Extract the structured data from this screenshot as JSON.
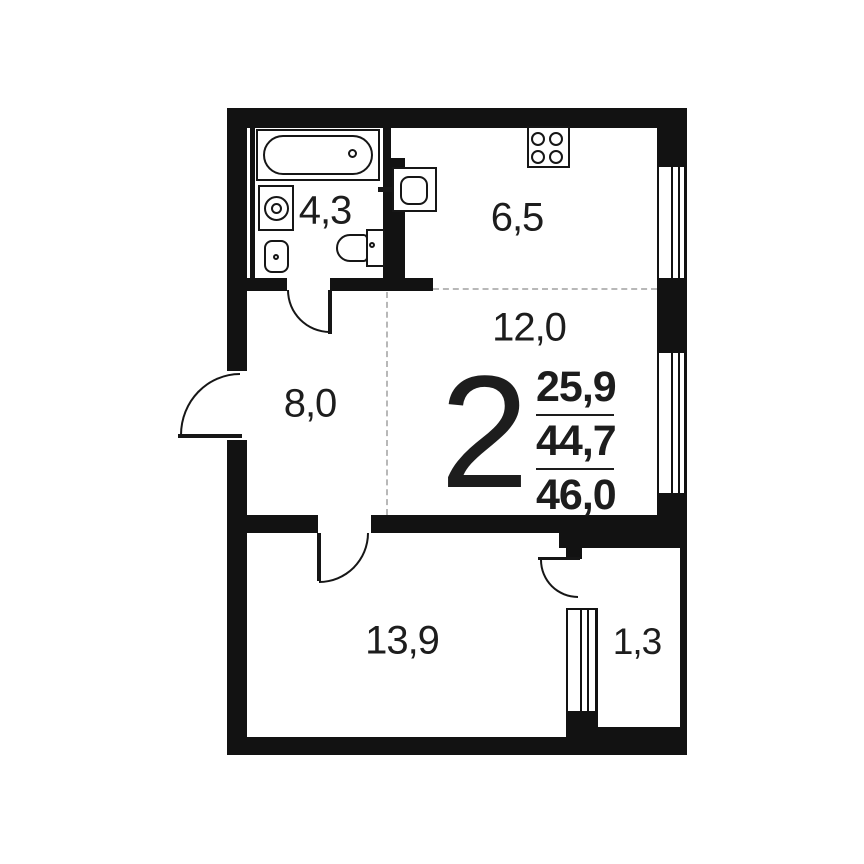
{
  "plan": {
    "title": "2-room apartment floor plan",
    "summary": {
      "rooms_count": "2",
      "living_area": "25,9",
      "area_without_balcony": "44,7",
      "total_area": "46,0"
    },
    "rooms": [
      {
        "id": "bathroom",
        "area": "4,3"
      },
      {
        "id": "kitchen",
        "area": "6,5"
      },
      {
        "id": "living-room",
        "area": "12,0"
      },
      {
        "id": "hallway",
        "area": "8,0"
      },
      {
        "id": "bedroom",
        "area": "13,9"
      },
      {
        "id": "balcony",
        "area": "1,3"
      }
    ],
    "fixtures": [
      "bathtub-icon",
      "washing-machine-icon",
      "bathroom-sink-icon",
      "toilet-icon",
      "kitchen-sink-icon",
      "stove-4-burner-icon",
      "window-icon",
      "door-swing-icon"
    ],
    "colors": {
      "wall": "#121212",
      "fixture_line": "#161616",
      "dashed_line": "#b8b8b8",
      "text": "#1d1d1d",
      "background": "#ffffff"
    }
  }
}
